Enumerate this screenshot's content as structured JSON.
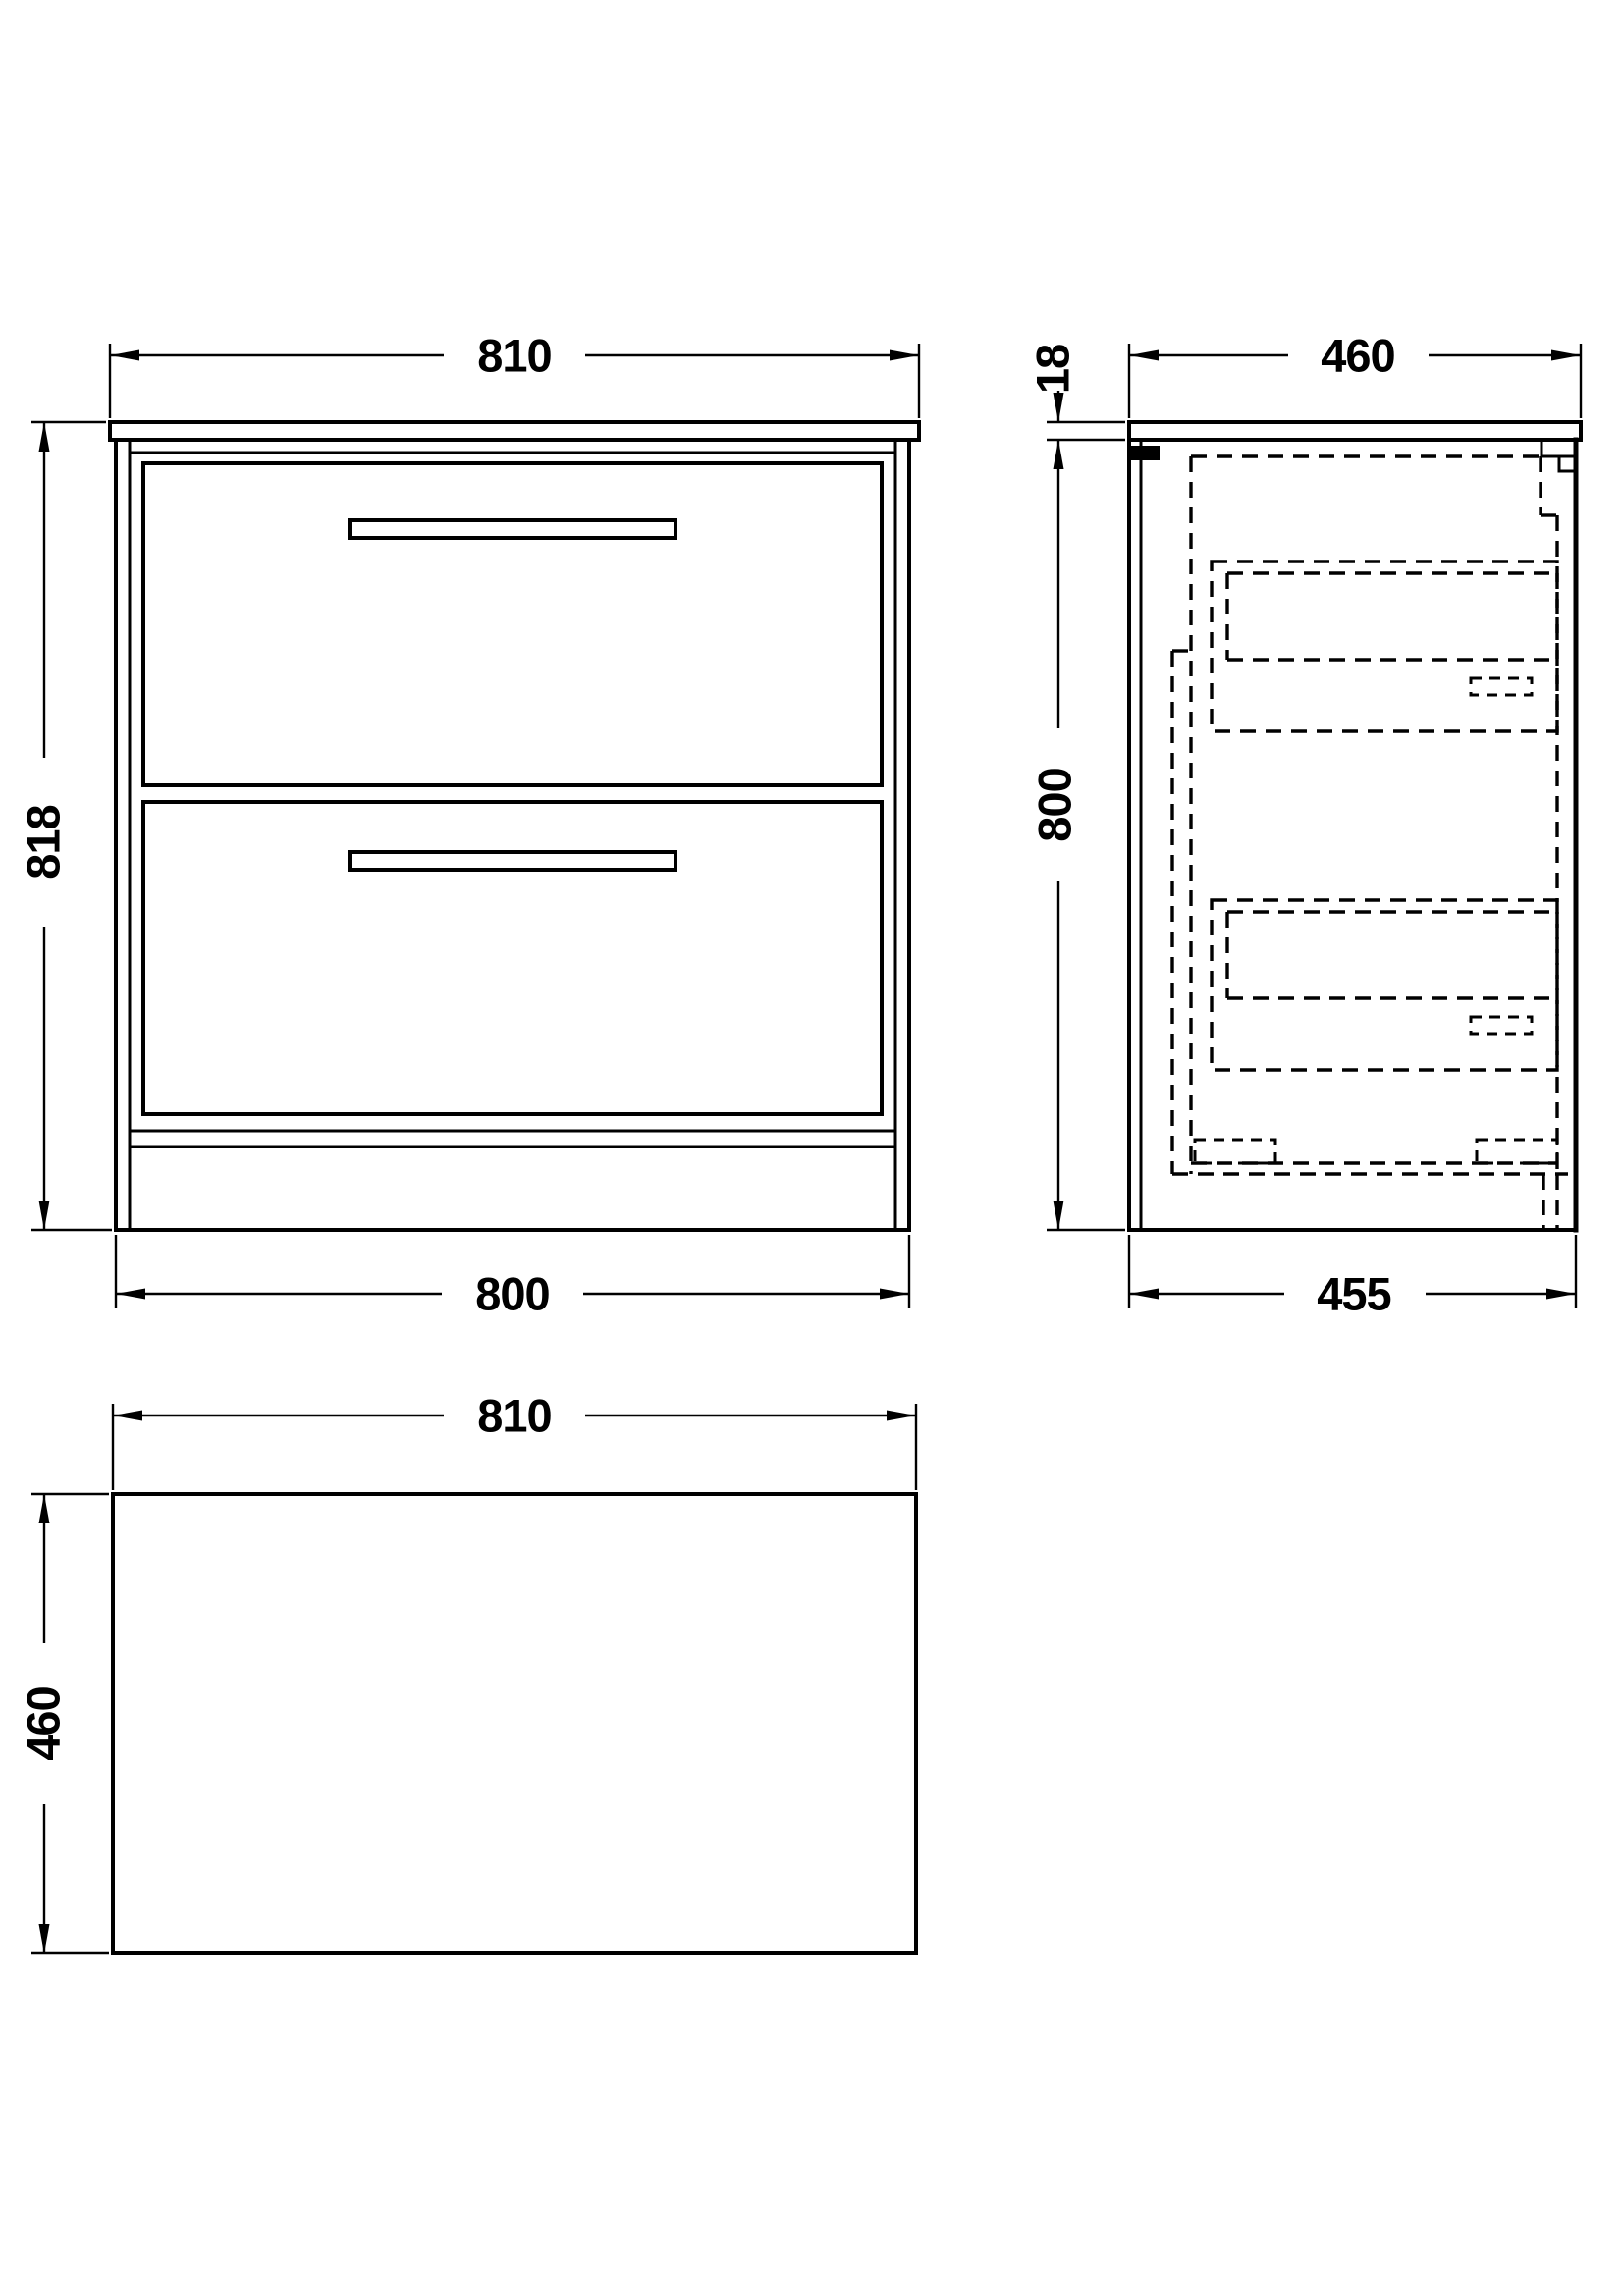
{
  "colors": {
    "background": "#ffffff",
    "line": "#000000"
  },
  "views": {
    "front": {
      "dim_top": "810",
      "dim_left": "818",
      "dim_bottom": "800"
    },
    "side": {
      "dim_top": "460",
      "dim_thickness": "18",
      "dim_left": "800",
      "dim_bottom": "455"
    },
    "plan": {
      "dim_top": "810",
      "dim_left": "460"
    }
  }
}
